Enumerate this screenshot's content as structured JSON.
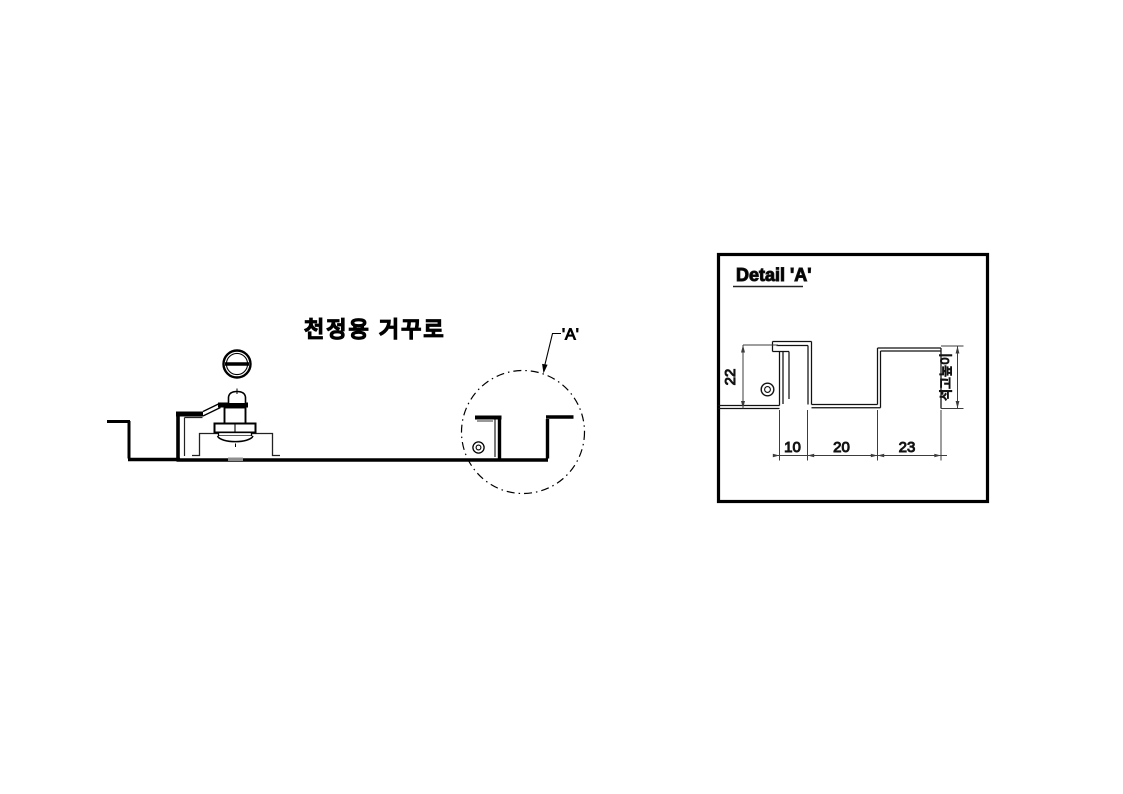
{
  "main_view": {
    "title": "천정용 거꾸로",
    "detail_callout": "'A'"
  },
  "detail_view": {
    "title": "Detail 'A'",
    "dim_height": "22",
    "dim_width_1": "10",
    "dim_width_2": "20",
    "dim_width_3": "23",
    "dim_side_note": "석고높이"
  },
  "colors": {
    "line": "#000000",
    "thin_line": "#1c1c1c",
    "dim_line": "#3c3c3c",
    "weld_mark": "#8f8f8f",
    "background": "#ffffff"
  }
}
